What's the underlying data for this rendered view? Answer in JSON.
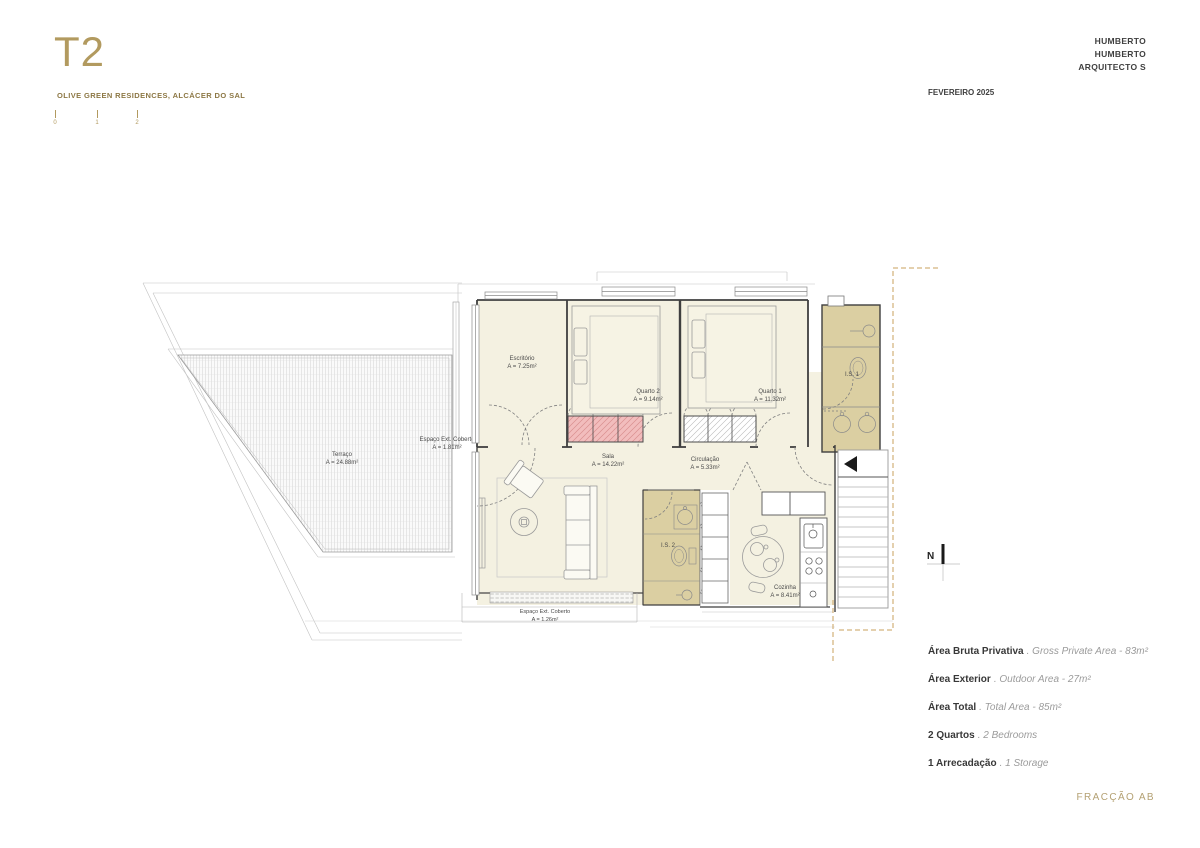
{
  "header": {
    "unit": "T2",
    "project": "OLIVE GREEN RESIDENCES, ALCÁCER DO SAL",
    "architect_line1": "HUMBERTO",
    "architect_line2": "HUMBERTO",
    "architect_line3": "ARQUITECTO S",
    "date": "FEVEREIRO 2025",
    "scale_ticks": [
      "0",
      "1",
      "2"
    ]
  },
  "plan": {
    "north_label": "N",
    "rooms": {
      "terraco": {
        "name": "Terraço",
        "area": "A = 24.88m²"
      },
      "espaco_ext_lateral": {
        "name": "Espaço Ext. Coberto",
        "area": "A = 1.81m²"
      },
      "escritorio": {
        "name": "Escritório",
        "area": "A = 7.25m²"
      },
      "quarto2": {
        "name": "Quarto 2",
        "area": "A = 9.14m²"
      },
      "quarto1": {
        "name": "Quarto 1",
        "area": "A = 11.32m²"
      },
      "is1": {
        "name": "I.S. 1"
      },
      "sala": {
        "name": "Sala",
        "area": "A = 14.22m²"
      },
      "circulacao": {
        "name": "Circulação",
        "area": "A = 5.33m²"
      },
      "is2": {
        "name": "I.S. 2"
      },
      "cozinha": {
        "name": "Cozinha",
        "area": "A = 8.41m²"
      },
      "espaco_ext_inferior": {
        "name": "Espaço Ext. Coberto",
        "area": "A = 1.26m²"
      }
    }
  },
  "summary": {
    "rows": [
      {
        "label": "Área Bruta Privativa",
        "rest": ". Gross Private Area - 83m²"
      },
      {
        "label": "Área Exterior",
        "rest": ". Outdoor Area - 27m²"
      },
      {
        "label": "Área Total",
        "rest": ". Total Area - 85m²"
      },
      {
        "label": "2 Quartos",
        "rest": ". 2 Bedrooms"
      },
      {
        "label": "1 Arrecadação",
        "rest": ". 1 Storage"
      }
    ]
  },
  "footer": {
    "fraction": "FRACÇÃO AB"
  },
  "colors": {
    "accent_gold": "#b29a5f",
    "subtitle_gold": "#8d7845",
    "room_cream": "#f4f1e1",
    "bathroom_tan": "#dbcfa2",
    "wardrobe_pink": "#f2bdbd",
    "boundary_dash_gold": "#c9a05e",
    "ink": "#3f3f3f",
    "muted": "#9b9b9b"
  }
}
